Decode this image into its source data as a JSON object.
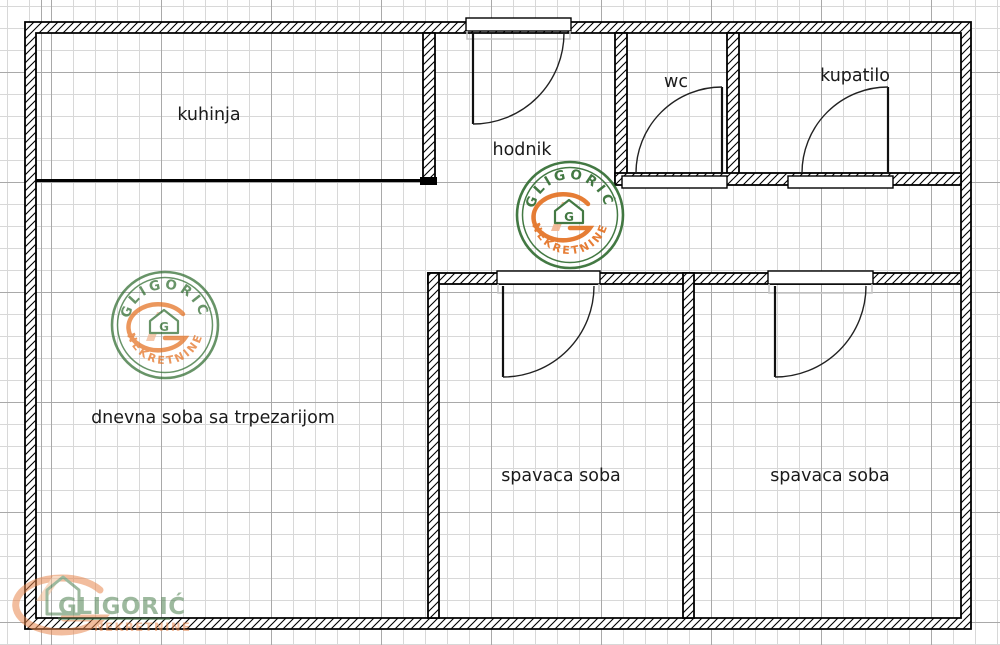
{
  "plan": {
    "rooms": [
      {
        "name": "kuhinja"
      },
      {
        "name": "hodnik"
      },
      {
        "name": "wc"
      },
      {
        "name": "kupatilo"
      },
      {
        "name": "dnevna soba sa trpezarijom"
      },
      {
        "name": "spavaca soba"
      },
      {
        "name": "spavaca soba"
      }
    ]
  },
  "watermark": {
    "brand": "GLIGORIĆ",
    "tagline": "NEKRETNINE",
    "monogram": "G"
  },
  "colors": {
    "stamp_green": "#2f6b2f",
    "stamp_orange": "#e47020",
    "peach": "#f2b590",
    "wall": "#000000",
    "label_text": "#1b1b1b",
    "grid_minor": "#d8d8d8",
    "grid_major": "#a9a9a9"
  }
}
